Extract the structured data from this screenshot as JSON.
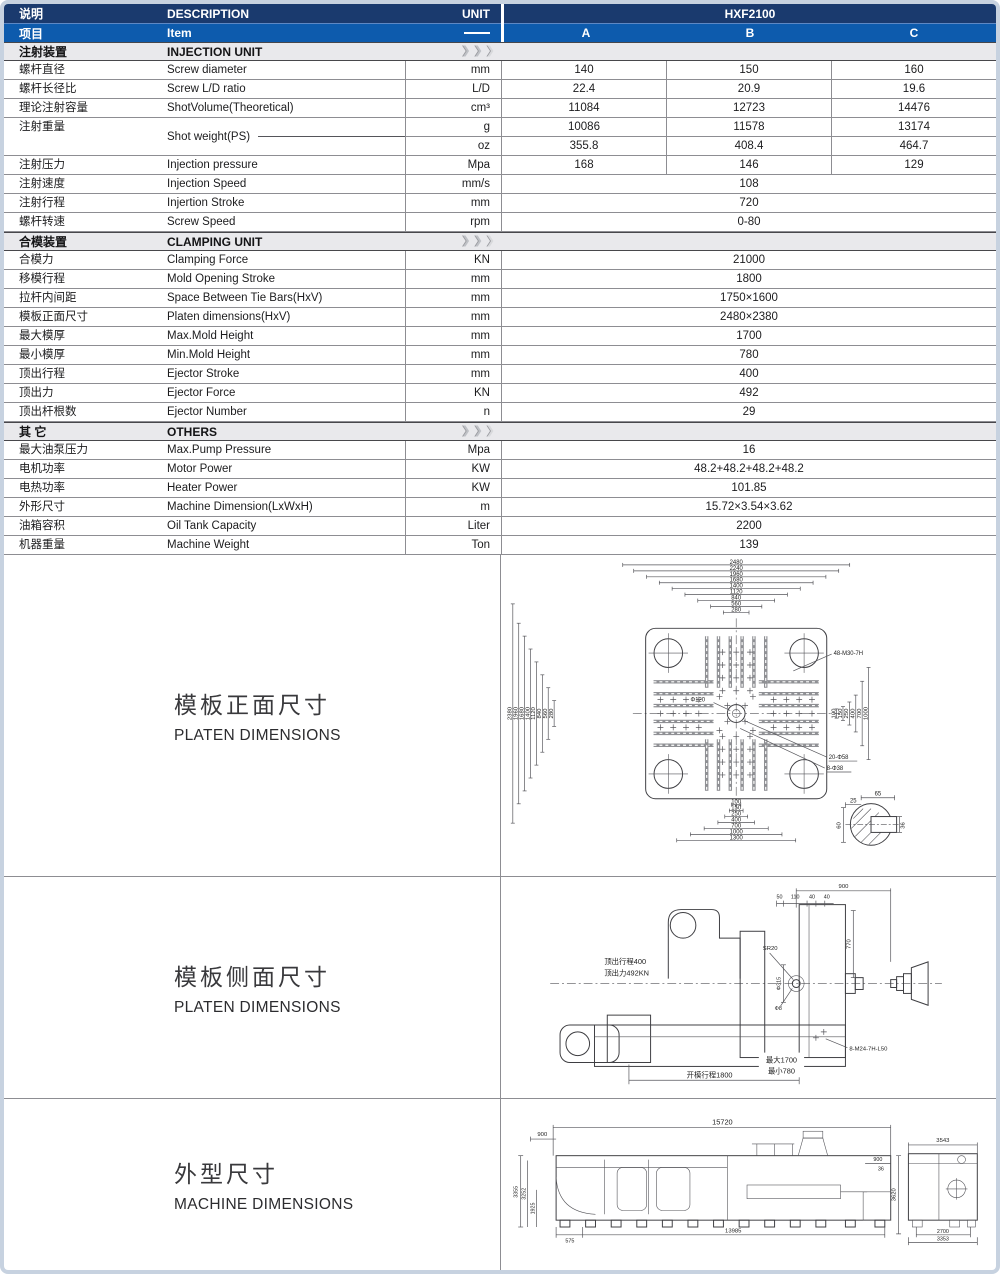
{
  "header": {
    "desc_cn": "说明",
    "item_cn": "项目",
    "desc_en": "DESCRIPTION",
    "item_en": "Item",
    "unit_label": "UNIT",
    "model": "HXF2100",
    "variants": [
      "A",
      "B",
      "C"
    ]
  },
  "icons": {
    "section_chevron_glyph": "❯"
  },
  "colors": {
    "navy": "#1a3a6e",
    "blue": "#0d5bad",
    "section_bg": "#e9e9ec",
    "line_gray": "#8d8d92"
  },
  "rows": [
    {
      "type": "section",
      "cn": "注射装置",
      "en": "INJECTION UNIT"
    },
    {
      "type": "abc",
      "cn": "螺杆直径",
      "en": "Screw diameter",
      "unit": "mm",
      "a": "140",
      "b": "150",
      "c": "160"
    },
    {
      "type": "abc",
      "cn": "螺杆长径比",
      "en": "Screw L/D ratio",
      "unit": "L/D",
      "a": "22.4",
      "b": "20.9",
      "c": "19.6"
    },
    {
      "type": "abc",
      "cn": "理论注射容量",
      "en": "ShotVolume(Theoretical)",
      "unit": "cm³",
      "a": "11084",
      "b": "12723",
      "c": "14476"
    },
    {
      "type": "dual",
      "cn": "注射重量",
      "en": "Shot weight(PS)",
      "sub": [
        {
          "unit": "g",
          "a": "10086",
          "b": "11578",
          "c": "13174"
        },
        {
          "unit": "oz",
          "a": "355.8",
          "b": "408.4",
          "c": "464.7"
        }
      ]
    },
    {
      "type": "abc",
      "cn": "注射压力",
      "en": "Injection pressure",
      "unit": "Mpa",
      "a": "168",
      "b": "146",
      "c": "129"
    },
    {
      "type": "span",
      "cn": "注射速度",
      "en": "Injection Speed",
      "unit": "mm/s",
      "value": "108"
    },
    {
      "type": "span",
      "cn": "注射行程",
      "en": "Injertion Stroke",
      "unit": "mm",
      "value": "720"
    },
    {
      "type": "span",
      "cn": "螺杆转速",
      "en": "Screw Speed",
      "unit": "rpm",
      "value": "0-80"
    },
    {
      "type": "section",
      "cn": "合模装置",
      "en": "CLAMPING UNIT"
    },
    {
      "type": "span",
      "cn": "合模力",
      "en": "Clamping Force",
      "unit": "KN",
      "value": "21000"
    },
    {
      "type": "span",
      "cn": "移模行程",
      "en": "Mold Opening Stroke",
      "unit": "mm",
      "value": "1800"
    },
    {
      "type": "span",
      "cn": "拉杆内间距",
      "en": "Space Between Tie Bars(HxV)",
      "unit": "mm",
      "value": "1750×1600"
    },
    {
      "type": "span",
      "cn": "模板正面尺寸",
      "en": "Platen dimensions(HxV)",
      "unit": "mm",
      "value": "2480×2380"
    },
    {
      "type": "span",
      "cn": "最大模厚",
      "en": "Max.Mold Height",
      "unit": "mm",
      "value": "1700"
    },
    {
      "type": "span",
      "cn": "最小模厚",
      "en": "Min.Mold Height",
      "unit": "mm",
      "value": "780"
    },
    {
      "type": "span",
      "cn": "顶出行程",
      "en": "Ejector Stroke",
      "unit": "mm",
      "value": "400"
    },
    {
      "type": "span",
      "cn": "顶出力",
      "en": "Ejector Force",
      "unit": "KN",
      "value": "492"
    },
    {
      "type": "span",
      "cn": "顶出杆根数",
      "en": "Ejector Number",
      "unit": "n",
      "value": "29"
    },
    {
      "type": "section",
      "cn": "其  它",
      "en": "OTHERS"
    },
    {
      "type": "span",
      "cn": "最大油泵压力",
      "en": "Max.Pump Pressure",
      "unit": "Mpa",
      "value": "16"
    },
    {
      "type": "span",
      "cn": "电机功率",
      "en": "Motor Power",
      "unit": "KW",
      "value": "48.2+48.2+48.2+48.2"
    },
    {
      "type": "span",
      "cn": "电热功率",
      "en": "Heater Power",
      "unit": "KW",
      "value": "101.85"
    },
    {
      "type": "span",
      "cn": "外形尺寸",
      "en": "Machine Dimension(LxWxH)",
      "unit": "m",
      "value": "15.72×3.54×3.62"
    },
    {
      "type": "span",
      "cn": "油箱容积",
      "en": "Oil Tank Capacity",
      "unit": "Liter",
      "value": "2200"
    },
    {
      "type": "span",
      "cn": "机器重量",
      "en": "Machine Weight",
      "unit": "Ton",
      "value": "139"
    }
  ],
  "drawings": {
    "platen_front": {
      "title_cn": "模板正面尺寸",
      "title_en": "PLATEN DIMENSIONS",
      "top_dims": [
        "2480",
        "2240",
        "1960",
        "1680",
        "1400",
        "1120",
        "840",
        "560",
        "280"
      ],
      "left_dims": [
        "2380",
        "1960",
        "1680",
        "1400",
        "1120",
        "840",
        "560",
        "280"
      ],
      "bottom_dims": [
        "100",
        "150",
        "250",
        "400",
        "700",
        "1000",
        "1300"
      ],
      "right_dims": [
        "100",
        "150",
        "250",
        "400",
        "700",
        "1000"
      ],
      "labels": {
        "bolt_pattern": "48-M30-7H",
        "center_hole": "Φ120",
        "holes_large": "20-Φ58",
        "holes_small": "8-Φ38"
      },
      "detail_dims": {
        "top": "65",
        "left": "25",
        "height": "60",
        "right": "36"
      }
    },
    "platen_side": {
      "title_cn": "模板侧面尺寸",
      "title_en": "PLATEN DIMENSIONS",
      "labels": {
        "top_width": "900",
        "off1": "50",
        "off2": "110",
        "off3": "40",
        "off4": "40",
        "height": "770",
        "nozzle_radius": "SR20",
        "ring": "Φ315",
        "hole": "Φ8",
        "ejector_stroke": "顶出行程400",
        "ejector_force": "顶出力492KN",
        "opening_stroke": "开模行程1800",
        "max_height": "最大1700",
        "min_height": "最小780",
        "bolts": "8-M24-7H-L50"
      }
    },
    "machine": {
      "title_cn": "外型尺寸",
      "title_en": "MACHINE DIMENSIONS",
      "labels": {
        "length": "15720",
        "left_top": "900",
        "h1": "3355",
        "h2": "3252",
        "h3": "1925",
        "base_left": "575",
        "base_length": "13985",
        "right_top": "900",
        "right_small": "36",
        "height_right": "3620",
        "end_width_top": "3543",
        "end_width_inner": "2700",
        "end_width": "3353"
      }
    }
  }
}
